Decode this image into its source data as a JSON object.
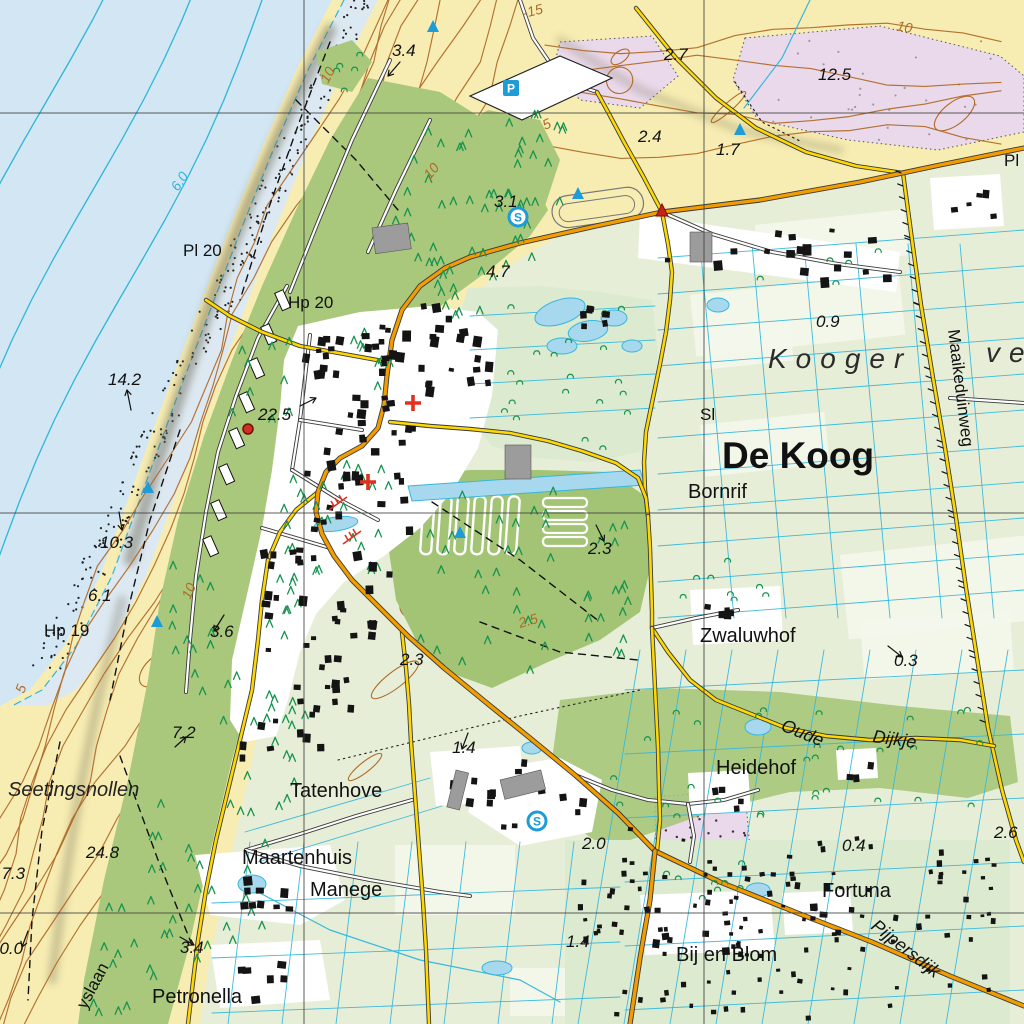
{
  "map": {
    "name": "topographic-map-de-koog-texel",
    "colors": {
      "sea": "#d2e6f3",
      "sea_contour": "#2fb6d9",
      "beach_wet": "#dde9f2",
      "sand": "#f7edb2",
      "contour_brown": "#b06a28",
      "ridge_shade": "#6f6a55",
      "dune_green": "#a9c87c",
      "forest_green": "#a3c475",
      "light_green": "#dcead0",
      "field": "#e7eed7",
      "parcel_white": "#f4f7ec",
      "village_white": "#ffffff",
      "building": "#141414",
      "building_gray": "#9c9c9c",
      "road_orange": "#f29c00",
      "road_yellow": "#ffd800",
      "road_casing": "#3a3a3a",
      "water_fill": "#a8d8ee",
      "water_line": "#35b7dc",
      "pink": "#ead9ea",
      "tree_green": "#17934f",
      "grid": "#3f3f3f",
      "marker_blue": "#1e9cd7",
      "marker_red": "#e03020"
    },
    "grid": {
      "vertical_x": [
        304,
        704
      ],
      "horizontal_y": [
        113,
        513,
        913
      ]
    },
    "region_labels": [
      {
        "text": "De Koog",
        "x": 722,
        "y": 468,
        "cls": "town"
      },
      {
        "text": "Kooger",
        "x": 768,
        "y": 368,
        "cls": "area"
      },
      {
        "text": "vel",
        "x": 986,
        "y": 362,
        "cls": "area"
      },
      {
        "text": "Bornrif",
        "x": 688,
        "y": 498,
        "cls": "hamlet"
      },
      {
        "text": "Sl",
        "x": 700,
        "y": 420,
        "cls": "small"
      },
      {
        "text": "Zwaluwhof",
        "x": 700,
        "y": 642,
        "cls": "hamlet"
      },
      {
        "text": "Heidehof",
        "x": 716,
        "y": 774,
        "cls": "hamlet"
      },
      {
        "text": "Fortuna",
        "x": 822,
        "y": 897,
        "cls": "hamlet"
      },
      {
        "text": "Bij en Blom",
        "x": 676,
        "y": 961,
        "cls": "hamlet"
      },
      {
        "text": "Tatenhove",
        "x": 290,
        "y": 797,
        "cls": "hamlet"
      },
      {
        "text": "Maartenhuis",
        "x": 242,
        "y": 864,
        "cls": "hamlet"
      },
      {
        "text": "Manege",
        "x": 310,
        "y": 896,
        "cls": "hamlet"
      },
      {
        "text": "Petronella",
        "x": 152,
        "y": 1003,
        "cls": "hamlet"
      },
      {
        "text": "Seetingsnollen",
        "x": 8,
        "y": 796,
        "cls": "terrain"
      },
      {
        "text": "Hp 19",
        "x": 44,
        "y": 636,
        "cls": "small"
      },
      {
        "text": "Hp 20",
        "x": 288,
        "y": 308,
        "cls": "small"
      },
      {
        "text": "Pl 20",
        "x": 183,
        "y": 256,
        "cls": "small"
      },
      {
        "text": "Pl",
        "x": 1004,
        "y": 166,
        "cls": "small"
      }
    ],
    "road_labels": [
      {
        "text": "Maaikeduinweg",
        "x": 948,
        "y": 330,
        "rot": 83,
        "cls": "road"
      },
      {
        "text": "Oude",
        "x": 780,
        "y": 730,
        "rot": 22,
        "cls": "road-it"
      },
      {
        "text": "Dijkje",
        "x": 872,
        "y": 742,
        "rot": 8,
        "cls": "road-it"
      },
      {
        "text": "Pijpersdijk",
        "x": 870,
        "y": 928,
        "rot": 38,
        "cls": "road-it"
      },
      {
        "text": "yslaan",
        "x": 86,
        "y": 1010,
        "rot": -62,
        "cls": "road"
      }
    ],
    "spot_heights": [
      {
        "v": "3.4",
        "x": 392,
        "y": 56
      },
      {
        "v": "2.7",
        "x": 664,
        "y": 60
      },
      {
        "v": "12.5",
        "x": 818,
        "y": 80
      },
      {
        "v": "2.4",
        "x": 638,
        "y": 142
      },
      {
        "v": "1.7",
        "x": 716,
        "y": 155
      },
      {
        "v": "3.1",
        "x": 494,
        "y": 207
      },
      {
        "v": "4.7",
        "x": 486,
        "y": 277
      },
      {
        "v": "0.9",
        "x": 816,
        "y": 327
      },
      {
        "v": "14.2",
        "x": 108,
        "y": 385
      },
      {
        "v": "22.5",
        "x": 258,
        "y": 420
      },
      {
        "v": "10.3",
        "x": 100,
        "y": 548
      },
      {
        "v": "6.1",
        "x": 88,
        "y": 601
      },
      {
        "v": "3.6",
        "x": 210,
        "y": 637
      },
      {
        "v": "2.3",
        "x": 588,
        "y": 554
      },
      {
        "v": "2.3",
        "x": 400,
        "y": 665
      },
      {
        "v": "0.3",
        "x": 894,
        "y": 666
      },
      {
        "v": "7.2",
        "x": 172,
        "y": 738
      },
      {
        "v": "1.4",
        "x": 452,
        "y": 753
      },
      {
        "v": "2.0",
        "x": 582,
        "y": 849
      },
      {
        "v": "24.8",
        "x": 86,
        "y": 858
      },
      {
        "v": "17.3",
        "x": -8,
        "y": 879
      },
      {
        "v": "20.0",
        "x": -10,
        "y": 954
      },
      {
        "v": "3.4",
        "x": 180,
        "y": 953
      },
      {
        "v": "1.4",
        "x": 566,
        "y": 947
      },
      {
        "v": "0.4",
        "x": 842,
        "y": 851
      },
      {
        "v": "2.6",
        "x": 994,
        "y": 838
      }
    ],
    "contour_labels": [
      {
        "v": "-15",
        "x": 524,
        "y": 18,
        "rot": -14,
        "c": "brown"
      },
      {
        "v": "10",
        "x": 896,
        "y": 30,
        "rot": 12,
        "c": "brown"
      },
      {
        "v": "10",
        "x": 328,
        "y": 84,
        "rot": -62,
        "c": "brown"
      },
      {
        "v": "10",
        "x": 430,
        "y": 180,
        "rot": -50,
        "c": "brown"
      },
      {
        "v": "5",
        "x": 545,
        "y": 130,
        "rot": -24,
        "c": "brown"
      },
      {
        "v": "6.0",
        "x": 178,
        "y": 192,
        "rot": -56,
        "c": "cyan"
      },
      {
        "v": "10",
        "x": 190,
        "y": 600,
        "rot": -66,
        "c": "brown"
      },
      {
        "v": "5",
        "x": 24,
        "y": 694,
        "rot": -70,
        "c": "brown"
      },
      {
        "v": "2.5",
        "x": 520,
        "y": 628,
        "rot": -16,
        "c": "brown"
      }
    ],
    "map_icons": [
      {
        "type": "parking",
        "letter": "P",
        "x": 511,
        "y": 88
      },
      {
        "type": "s-circle",
        "letter": "S",
        "x": 518,
        "y": 217
      },
      {
        "type": "s-circle",
        "letter": "S",
        "x": 537,
        "y": 821
      },
      {
        "type": "blue-triangle",
        "x": 433,
        "y": 27
      },
      {
        "type": "blue-triangle",
        "x": 578,
        "y": 194
      },
      {
        "type": "blue-triangle",
        "x": 740,
        "y": 130
      },
      {
        "type": "blue-triangle",
        "x": 148,
        "y": 488
      },
      {
        "type": "blue-triangle",
        "x": 157,
        "y": 622
      },
      {
        "type": "blue-triangle",
        "x": 460,
        "y": 533
      },
      {
        "type": "red-triangle",
        "x": 662,
        "y": 211
      },
      {
        "type": "red-dot",
        "x": 248,
        "y": 429
      },
      {
        "type": "church-cross",
        "x": 413,
        "y": 403
      },
      {
        "type": "church-cross",
        "x": 368,
        "y": 482
      },
      {
        "type": "red-mast",
        "x": 338,
        "y": 503
      },
      {
        "type": "red-mast",
        "x": 352,
        "y": 537
      }
    ]
  }
}
